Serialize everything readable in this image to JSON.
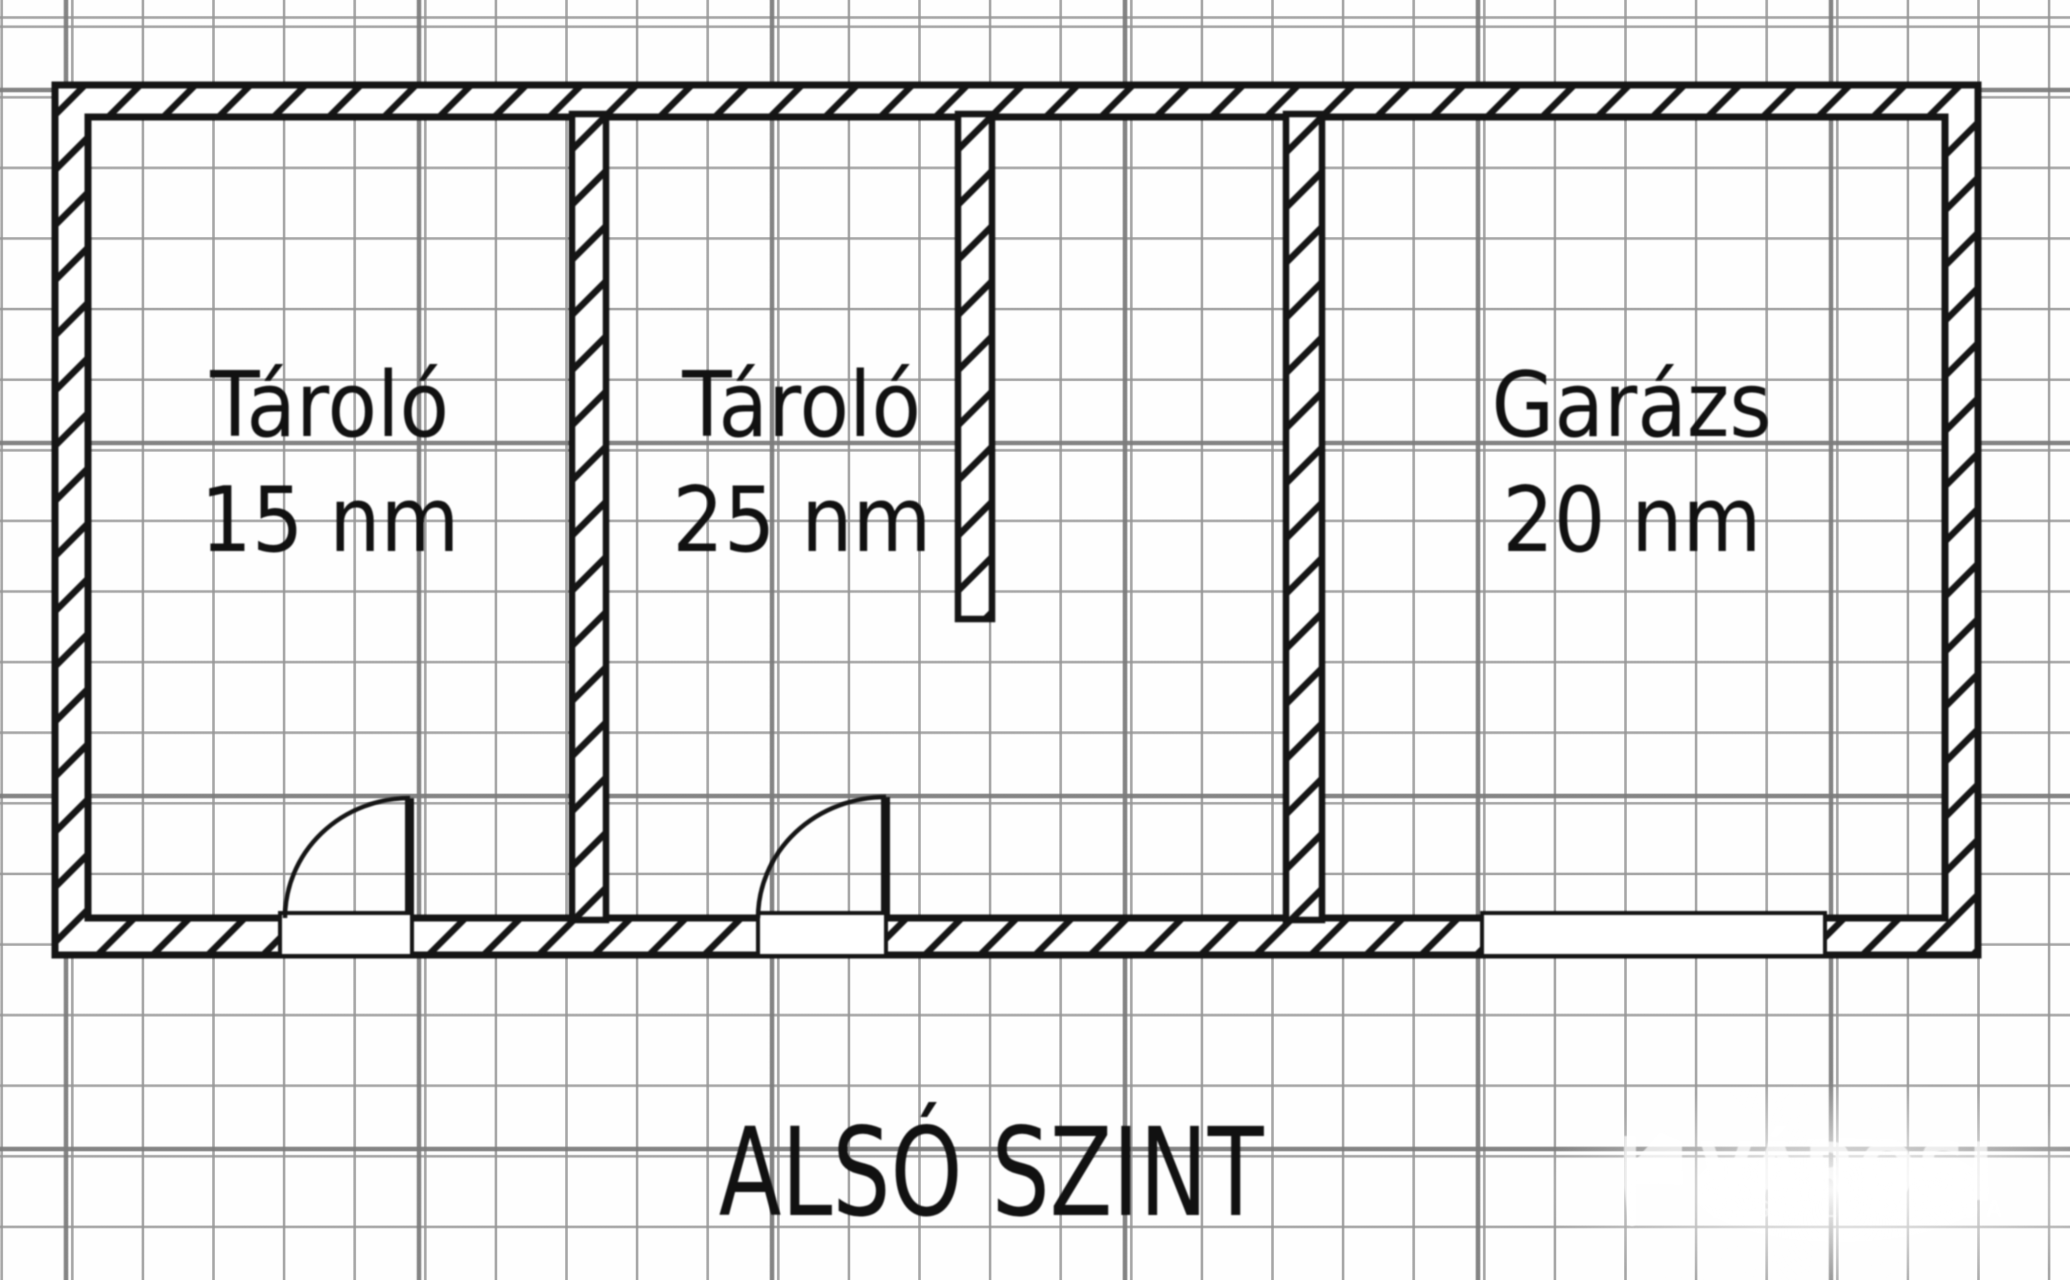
{
  "floor_plan": {
    "title": "ALSÓ SZINT",
    "rooms": [
      {
        "name": "Tároló",
        "area": "15 nm"
      },
      {
        "name": "Tároló",
        "area": "25 nm"
      },
      {
        "name": "Garázs",
        "area": "20 nm"
      }
    ]
  },
  "watermark": {
    "brand": "VÁROSI",
    "subtitle": "INGATLANIRODA"
  },
  "colors": {
    "wall_ink": "#151515",
    "grid_minor": "#969696",
    "grid_major": "#7d7d7d",
    "paper": "#fefefe",
    "watermark_white": "#ffffff"
  }
}
